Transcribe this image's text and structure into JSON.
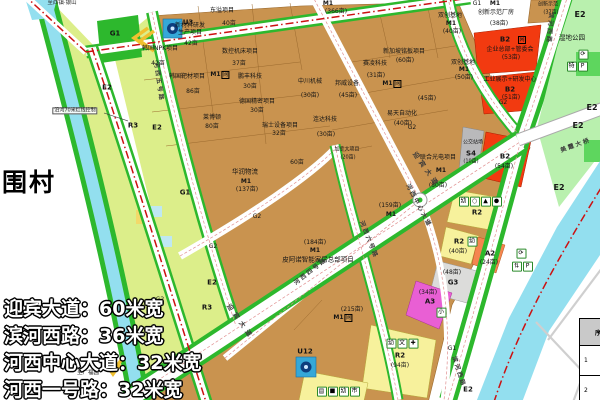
{
  "map": {
    "destinations": {
      "top": "至西镇·银山",
      "bottom": "至广福园"
    },
    "village": "围村",
    "note": "沿河70米红线控制",
    "road_widths": {
      "w1": "迎宾大道：60米宽",
      "w2": "滨河西路：36米宽",
      "w3": "河西中心大道：32米宽",
      "w4": "河西一号路：32米宽"
    },
    "roads": {
      "yingbin": "迎宾大道",
      "binhexi": "滨河西路",
      "center": "河西中心大道",
      "no4": "河西四号路",
      "no5": "河西五号路",
      "no6": "河西六号路",
      "bridge": "美霞大桥"
    },
    "codes": {
      "m1": "M1",
      "b2": "B2",
      "r2": "R2",
      "r3": "R3",
      "a2": "A2",
      "a3": "A3",
      "g1": "G1",
      "g2": "G2",
      "g3": "G3",
      "s4": "S4",
      "e2": "E2",
      "u3": "U3",
      "u12": "U12",
      "box": "网"
    },
    "parcels": {
      "npk": "韩国NPK项目",
      "npk_a": "42亩",
      "xincai1": "新材料研发",
      "xincai2": "生产项目",
      "xincai_a": "42亩",
      "dongyi": "东溢项目",
      "dongyi_a": "40亩",
      "shukong": "数控机床项目",
      "shukong_a": "37亩",
      "bacai": "韩国靶材项目",
      "bacai_a": "86亩",
      "pengfeng": "鹏丰科技",
      "pengfeng_a": "30亩",
      "deguo": "德国精密项目",
      "deguo_a": "30亩",
      "laibodun": "莱博顿",
      "laibodun_a": "80亩",
      "ruishi": "瑞士设备项目",
      "ruishi_a": "32亩",
      "huarun": "华润物流",
      "huarun_a": "(137亩)",
      "a60": "60亩",
      "m366": "(366亩)",
      "shuangchuang": "双创基地",
      "sc1_a": "(40亩)",
      "sc2_a": "(50亩)",
      "cxsf_fang": "创新示范厂房",
      "cxsf_fang_a": "(38亩)",
      "cxsf": "创新示范",
      "cxsf_a": "(37亩)",
      "xinjiapo": "新加坡铭板项目",
      "xinjiapo_a": "(60亩)",
      "sailing": "赛凌科技",
      "sailing_a": "(31亩)",
      "zhongchuan": "中川机械",
      "zhongchuan_a": "(30亩)",
      "bangwei": "邦威设备",
      "bangwei_a": "(45亩)",
      "m45_a": "(45亩)",
      "yitian": "易天自动化",
      "yitian_a": "(40亩)",
      "lianda": "连达科技",
      "lianda_a": "(30亩)",
      "jianada": "加拿大项目",
      "jianada_a": "(20亩)",
      "lianhe": "联合光电项目",
      "lianhe_a": "(80亩)",
      "m159": "(159亩)",
      "m184": "(184亩)",
      "piano": "皮阿诺智能家居总部项目",
      "m215": "(215亩)",
      "b2_hq": "企业总部+管委会",
      "b2_hq_a": "(53亩)",
      "b2_expo": "工业展示+研发中心",
      "b2_expo_a": "(51亩)",
      "b2_54a": "(54亩)",
      "s4_bus": "公交站场",
      "s4_a": "(10亩)",
      "r2_40a": "(40亩)",
      "a2_24a": "(24亩)",
      "g3_48a": "(48亩)",
      "a3_34a": "(34亩)",
      "r2_94a": "(94亩)",
      "wetland": "湿地公园"
    },
    "icons": {
      "recycle": "⟳",
      "parking": "P",
      "bus": "特",
      "pair": "⇅",
      "kind": "幼",
      "primary": "小",
      "culture": "文",
      "medical": "✚",
      "market": "市",
      "grid": "▤",
      "square": "■",
      "circle": "○",
      "triangle": "▲",
      "dot": "●"
    },
    "table": {
      "header": "序号",
      "row1": "1",
      "row2": "2"
    },
    "colors": {
      "industrial": "#c9934f",
      "business": "#f23a10",
      "residential": "#f7f19c",
      "admin": "#f5854f",
      "school": "#e95fd4",
      "green": "#2db82d",
      "wetland": "#b9f0ae",
      "water": "#93dfef",
      "boundary": "#cc1111",
      "left_green": "#dcee8a"
    }
  }
}
